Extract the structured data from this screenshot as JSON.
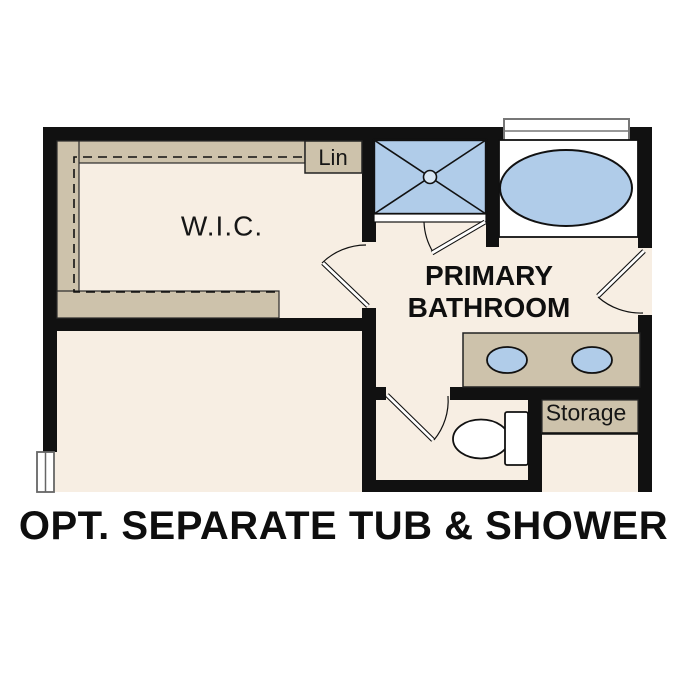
{
  "caption": {
    "text": "OPT. SEPARATE TUB & SHOWER"
  },
  "rooms": {
    "wic": {
      "label": "W.I.C."
    },
    "linen": {
      "label": "Lin"
    },
    "primary_bathroom": {
      "label": "PRIMARY BATHROOM"
    },
    "storage": {
      "label": "Storage"
    }
  },
  "fixtures": {
    "icons": [
      "shower-icon",
      "bathtub-icon",
      "toilet-icon",
      "sink-icon",
      "double-vanity-icon",
      "door-swing-icon",
      "window-icon",
      "closet-rod-icon",
      "storage-shelf-icon"
    ]
  },
  "colors": {
    "wall": "#111111",
    "floor": "#f7eee3",
    "cabinetry_tan": "#cdc2ab",
    "fixture_blue": "#b0cce9",
    "fixture_outline": "#111111",
    "window_frame": "#777777",
    "background": "#ffffff",
    "text": "#161616"
  }
}
